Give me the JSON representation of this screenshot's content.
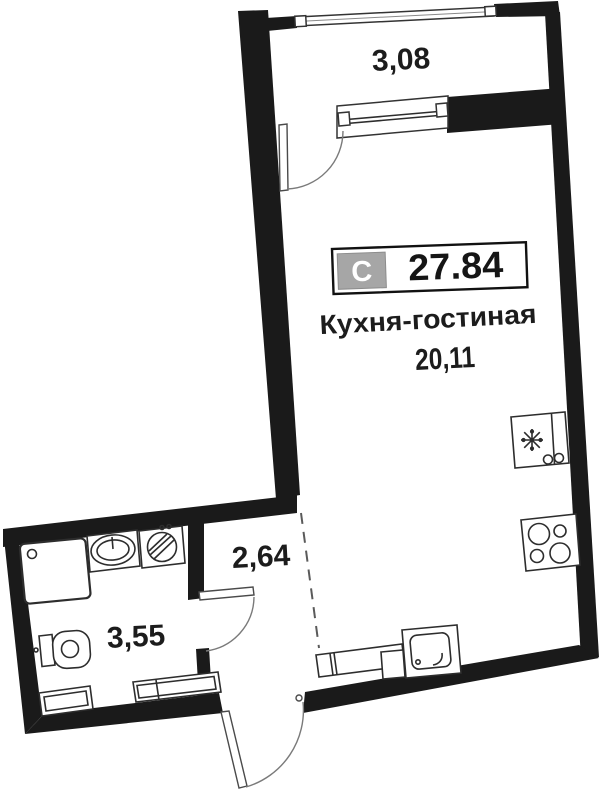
{
  "unit_badge": {
    "category_letter": "С",
    "total_area": "27.84"
  },
  "rooms": {
    "balcony": {
      "area": "3,08"
    },
    "kitchen_living_room": {
      "name": "Кухня-гостиная",
      "area": "20,11"
    },
    "hallway": {
      "area": "2,64"
    },
    "bathroom": {
      "area": "3,55"
    }
  },
  "fixtures": {
    "balcony": [
      "balcony-glazing",
      "balcony-window",
      "balcony-door"
    ],
    "kitchen_living_room": [
      "refrigerator",
      "stove",
      "kitchen-sink",
      "radiator"
    ],
    "bathroom": [
      "shower-tray",
      "washbasin",
      "washing-machine",
      "toilet",
      "radiator",
      "cabinet"
    ],
    "hallway": [
      "bathroom-door",
      "entrance-door"
    ]
  },
  "colors": {
    "walls": "#1a1a1a",
    "text": "#1c1c1c",
    "badge_gray": "#a6a6a6",
    "glazing_fill": "#e9e9e9",
    "line": "#2d2d2d"
  }
}
